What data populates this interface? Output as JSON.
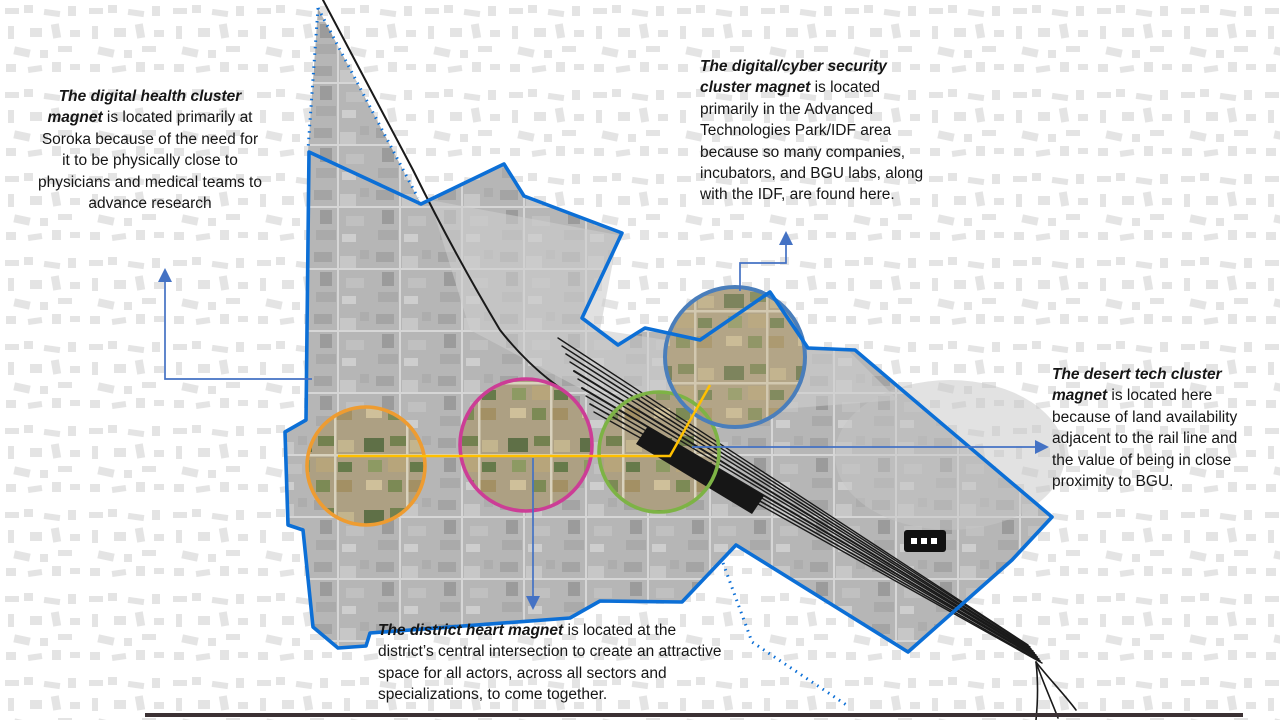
{
  "annotations": {
    "digital_health": {
      "lead": "The digital health cluster magnet",
      "body": " is located primarily at Soroka because of the need for it to be physically close to physicians and medical teams to advance research"
    },
    "cyber_security": {
      "lead": "The digital/cyber security cluster magnet",
      "body": " is located primarily in the Advanced Technologies Park/IDF area because so many companies, incubators, and BGU labs, along with the IDF, are found here."
    },
    "desert_tech": {
      "lead": "The desert tech cluster magnet",
      "body": " is located here because of land availability adjacent to the rail line and the value of being in close proximity to BGU."
    },
    "district_heart": {
      "lead": "The district heart magnet",
      "body": " is located at the district’s central intersection to create an attractive space for all actors, across all sectors and specializations, to come together."
    }
  },
  "map": {
    "boundary_color": "#0C6FD6",
    "corridor_color": "#FFC000",
    "callout_arrow_color": "#4472C4",
    "railway_color": "#1A1A1A",
    "bottom_rule_color": "#3B3134",
    "circles": [
      {
        "name": "digital-health-circle",
        "color": "#EE9C31"
      },
      {
        "name": "district-heart-circle",
        "color": "#CC3D96"
      },
      {
        "name": "desert-tech-circle",
        "color": "#7DB345"
      },
      {
        "name": "cyber-security-circle",
        "color": "#4A7EBB"
      }
    ]
  }
}
